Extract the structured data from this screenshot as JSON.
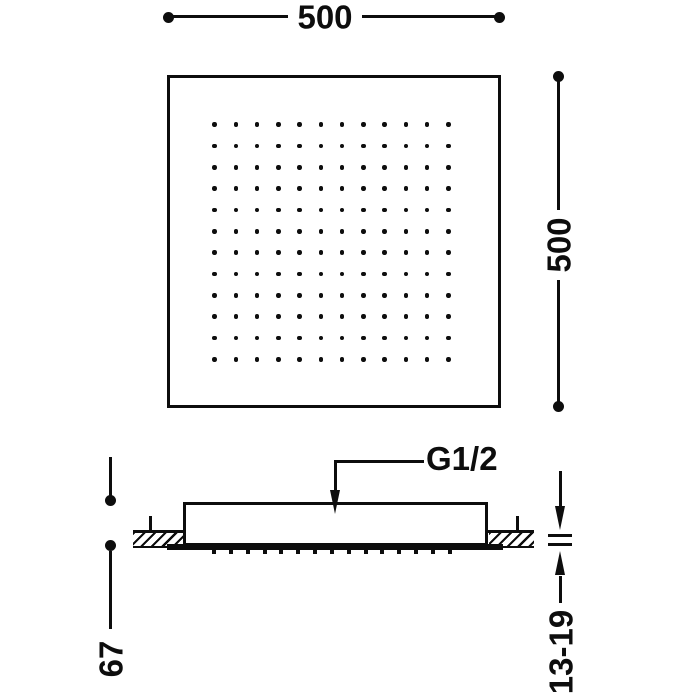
{
  "title": "Ceiling-recessed square shower head dimension drawing",
  "labels": {
    "width_dim": "500",
    "depth_dim": "500",
    "connection": "G1/2",
    "body_height_dim": "67",
    "ceiling_thickness_dim": "13-19"
  },
  "top_view": {
    "nozzle_rows": 12,
    "nozzle_cols": 12
  },
  "side_view": {
    "nozzle_dash_count": 15
  },
  "colors": {
    "ink": "#0d0d0d",
    "background": "#ffffff"
  }
}
